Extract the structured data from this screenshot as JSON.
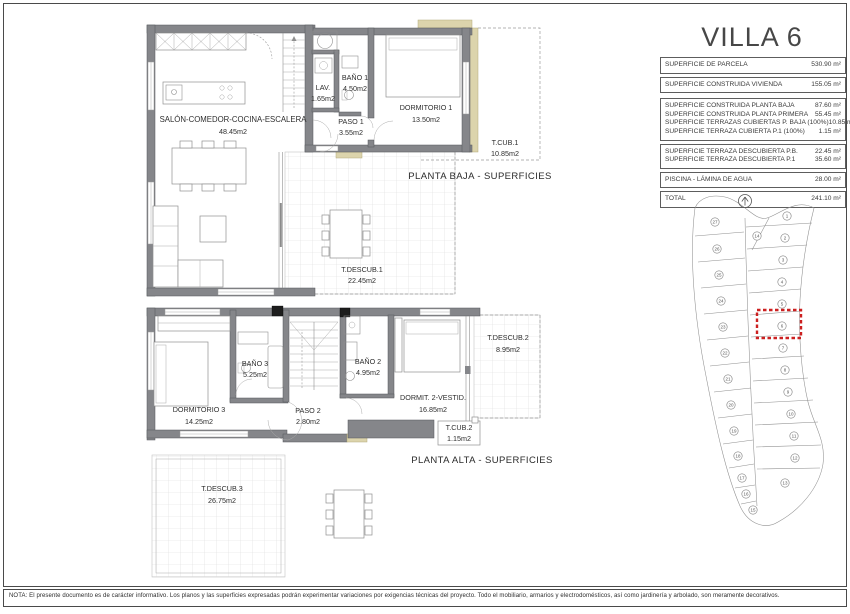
{
  "title": "VILLA 6",
  "colors": {
    "accent_red": "#cc2020",
    "wall_gray": "#85868a",
    "terrace_beige": "#dcd4ac"
  },
  "surface_table": {
    "groups": [
      {
        "rows": [
          {
            "label": "SUPERFICIE DE PARCELA",
            "value": "530.90 m²"
          }
        ]
      },
      {
        "rows": [
          {
            "label": "SUPERFICIE CONSTRUIDA VIVIENDA",
            "value": "155.05 m²"
          }
        ]
      },
      {
        "rows": [
          {
            "label": "SUPERFICIE CONSTRUIDA PLANTA BAJA",
            "value": "87.60 m²"
          },
          {
            "label": "SUPERFICIE CONSTRUIDA PLANTA PRIMERA",
            "value": "55.45 m²"
          },
          {
            "label": "SUPERFICIE TERRAZAS CUBIERTAS P. BAJA (100%)",
            "value": "10.85 m²"
          },
          {
            "label": "SUPERFICIE TERRAZA CUBIERTA P.1 (100%)",
            "value": "1.15 m²"
          }
        ]
      },
      {
        "rows": [
          {
            "label": "SUPERFICIE TERRAZA DESCUBIERTA P.B.",
            "value": "22.45 m²"
          },
          {
            "label": "SUPERFICIE TERRAZA DESCUBIERTA P.1",
            "value": "35.60 m²"
          }
        ]
      },
      {
        "rows": [
          {
            "label": "PISCINA - LÁMINA DE AGUA",
            "value": "28.00 m²"
          }
        ]
      },
      {
        "rows": [
          {
            "label": "TOTAL",
            "value": "241.10 m²"
          }
        ]
      }
    ]
  },
  "planta_baja": {
    "title": "PLANTA BAJA - SUPERFICIES",
    "rooms": {
      "salon": {
        "name": "SALÓN-COMEDOR-COCINA-ESCALERA",
        "area": "48.45m2"
      },
      "lav": {
        "name": "LAV.",
        "area": "1.65m2"
      },
      "bano1": {
        "name": "BAÑO 1",
        "area": "4.50m2"
      },
      "paso1": {
        "name": "PASO 1",
        "area": "3.55m2"
      },
      "dormitorio1": {
        "name": "DORMITORIO 1",
        "area": "13.50m2"
      },
      "tcub1": {
        "name": "T.CUB.1",
        "area": "10.85m2"
      },
      "tdescub1": {
        "name": "T.DESCUB.1",
        "area": "22.45m2"
      }
    }
  },
  "planta_alta": {
    "title": "PLANTA ALTA - SUPERFICIES",
    "rooms": {
      "dormitorio3": {
        "name": "DORMITORIO 3",
        "area": "14.25m2"
      },
      "bano3": {
        "name": "BAÑO 3",
        "area": "5.25m2"
      },
      "paso2": {
        "name": "PASO 2",
        "area": "2.80m2"
      },
      "bano2": {
        "name": "BAÑO 2",
        "area": "4.95m2"
      },
      "dormit2": {
        "name": "DORMIT. 2-VESTID.",
        "area": "16.85m2"
      },
      "tdescub2": {
        "name": "T.DESCUB.2",
        "area": "8.95m2"
      },
      "tcub2": {
        "name": "T.CUB.2",
        "area": "1.15m2"
      },
      "tdescub3": {
        "name": "T.DESCUB.3",
        "area": "26.75m2"
      }
    }
  },
  "site_plan": {
    "highlighted_plot": "6",
    "plots": [
      "1",
      "2",
      "3",
      "4",
      "5",
      "6",
      "7",
      "8",
      "9",
      "10",
      "11",
      "12",
      "13",
      "14",
      "27",
      "26",
      "25",
      "24",
      "23",
      "22",
      "21",
      "20",
      "19",
      "18",
      "17",
      "16",
      "15"
    ]
  },
  "note": "NOTA: El presente documento es de carácter informativo. Los planos y las superficies expresadas podrán experimentar variaciones por exigencias técnicas del proyecto. Todo el mobiliario, armarios y electrodomésticos, así como jardinería y arbolado, son meramente decorativos."
}
